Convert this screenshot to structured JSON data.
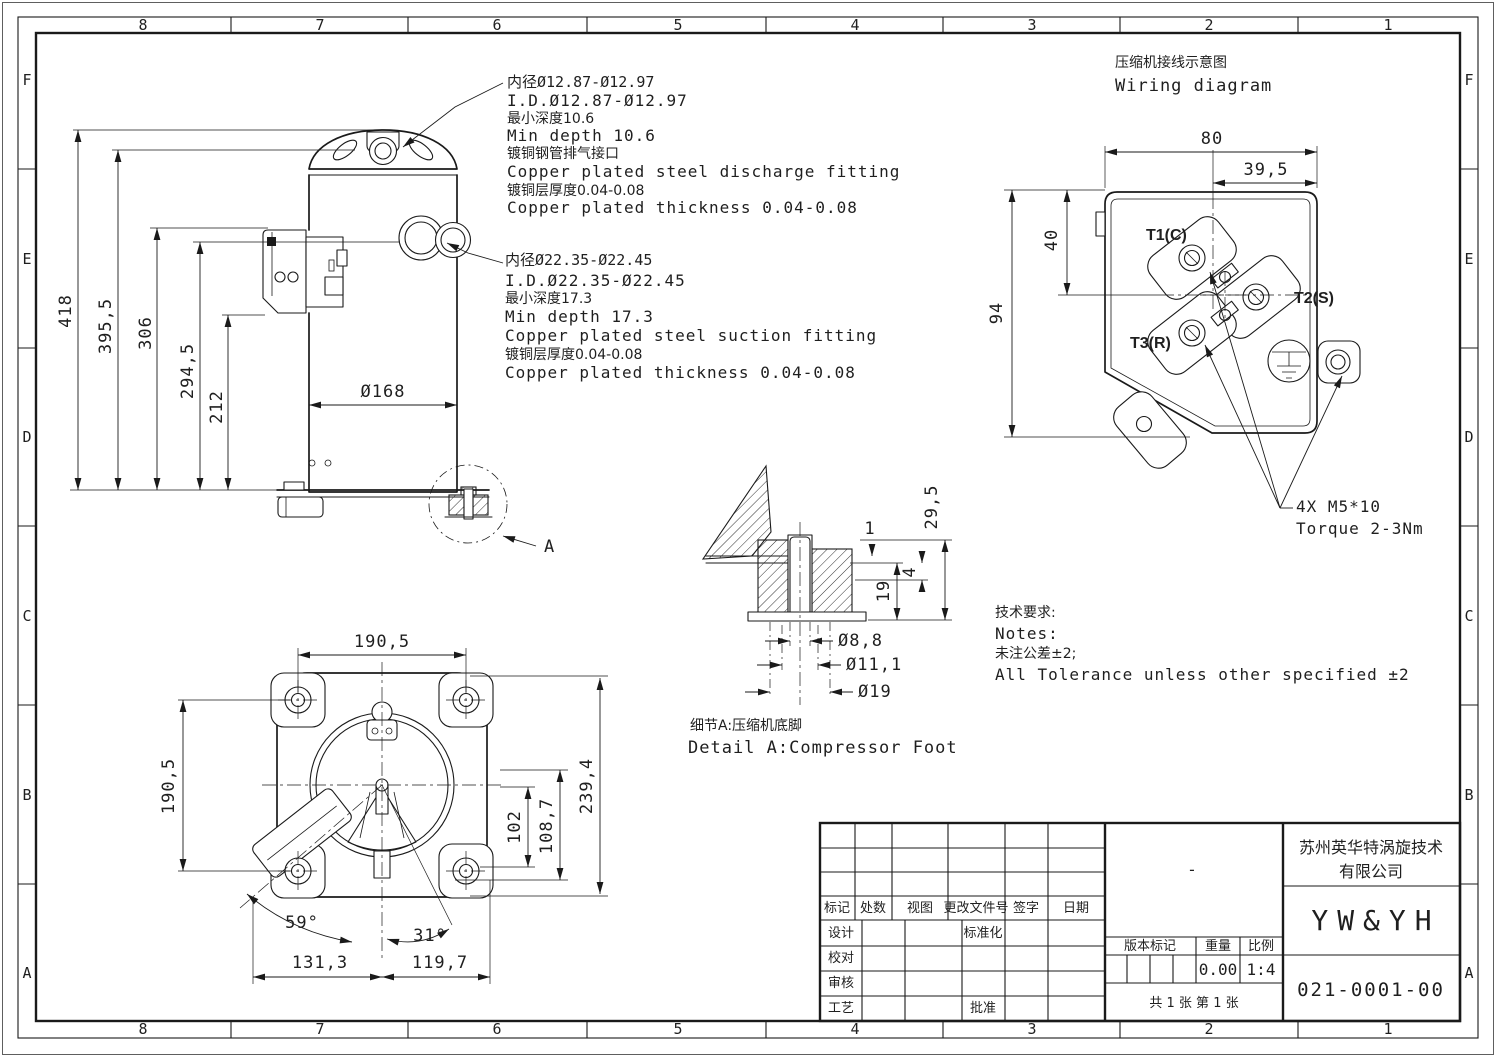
{
  "colors": {
    "paper": "#ffffff",
    "ink": "#1a1a1a"
  },
  "zones": {
    "top": [
      "8",
      "7",
      "6",
      "5",
      "4",
      "3",
      "2",
      "1"
    ],
    "bottom": [
      "8",
      "7",
      "6",
      "5",
      "4",
      "3",
      "2",
      "1"
    ],
    "left": [
      "F",
      "E",
      "D",
      "C",
      "B",
      "A"
    ],
    "right": [
      "F",
      "E",
      "D",
      "C",
      "B",
      "A"
    ]
  },
  "side_view": {
    "dims": {
      "total_height": "418",
      "shell_height": "395,5",
      "box_top": "306",
      "suction_center": "294,5",
      "box_bottom": "212",
      "shell_diameter": "Ø168"
    },
    "detail_marker": "A",
    "discharge_note": [
      "内径Ø12.87-Ø12.97",
      "I.D.Ø12.87-Ø12.97",
      "最小深度10.6",
      "Min depth 10.6",
      "镀铜钢管排气接口",
      "Copper plated steel discharge fitting",
      "镀铜层厚度0.04-0.08",
      "Copper plated thickness 0.04-0.08"
    ],
    "suction_note": [
      "内径Ø22.35-Ø22.45",
      "I.D.Ø22.35-Ø22.45",
      "最小深度17.3",
      "Min depth 17.3",
      "Copper plated steel suction fitting",
      "镀铜层厚度0.04-0.08",
      "Copper plated thickness 0.04-0.08"
    ]
  },
  "bottom_view": {
    "dims": {
      "top_width": "190,5",
      "left_height": "190,5",
      "diagonal": "239,4",
      "inner1": "102",
      "inner2": "108,7",
      "angle_a": "59°",
      "angle_b": "31°",
      "bottom_left": "131,3",
      "bottom_right": "119,7"
    }
  },
  "detail_a": {
    "dims": {
      "plate": "1",
      "total": "29,5",
      "inner": "19",
      "lip": "4",
      "hole": "Ø8,8",
      "washer": "Ø11,1",
      "grommet": "Ø19"
    },
    "caption_cn": "细节A:压缩机底脚",
    "caption_en": "Detail A:Compressor Foot"
  },
  "wiring": {
    "title_cn": "压缩机接线示意图",
    "title_en": "Wiring diagram",
    "dims": {
      "width": "80",
      "offset": "39,5",
      "height_upper": "40",
      "height_total": "94"
    },
    "terminals": [
      "T1(C)",
      "T2(S)",
      "T3(R)"
    ],
    "fastener_note": [
      "4X M5*10",
      "Torque 2-3Nm"
    ]
  },
  "notes": {
    "heading_cn": "技术要求:",
    "heading_en": "Notes:",
    "tolerance_cn": "未注公差±2;",
    "tolerance_en": "All Tolerance unless other specified ±2"
  },
  "title_block": {
    "revision_headers": [
      "标记",
      "处数",
      "视图",
      "更改文件号",
      "签字",
      "日期"
    ],
    "sig_labels": [
      "设计",
      "校对",
      "审核",
      "工艺"
    ],
    "standardization_label": "标准化",
    "approval_label": "批准",
    "version_label": "版本标记",
    "weight_label": "重量",
    "scale_label": "比例",
    "weight_value": "0.00",
    "scale_value": "1:4",
    "material_dash": "-",
    "company_line1": "苏州英华特涡旋技术",
    "company_line2": "有限公司",
    "product_model": "YW&YH",
    "drawing_number": "021-0001-00",
    "sheet_info": "共 1 张  第 1 张"
  }
}
